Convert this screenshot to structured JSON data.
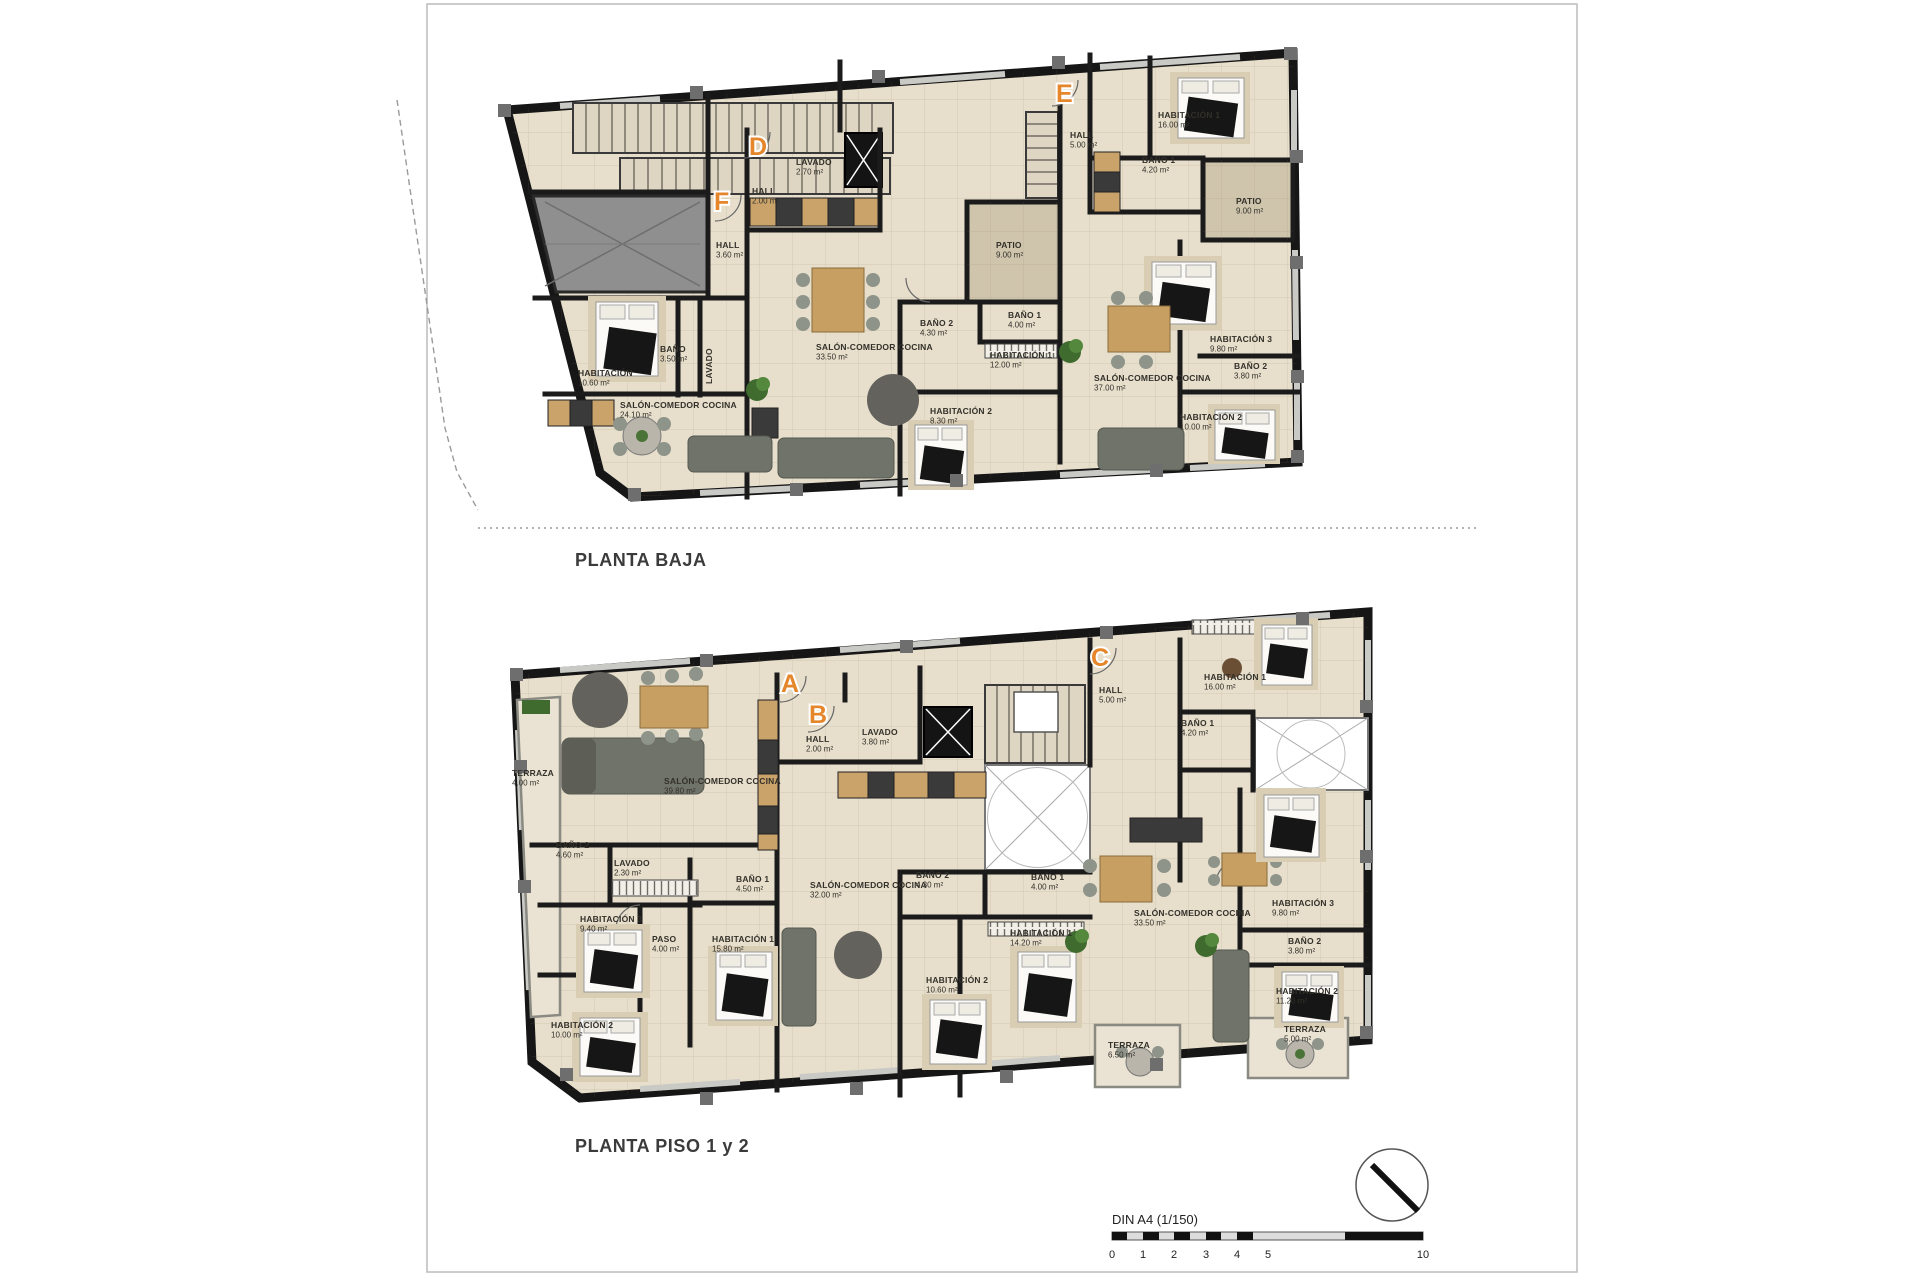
{
  "document": {
    "type": "architectural-floor-plans",
    "sheet_format": "DIN A4 (1/150)"
  },
  "colors": {
    "accent_orange": "#e5862b",
    "wall": "#1b1b1b",
    "floor": "#e7dfcc",
    "patio": "#cfc5ad",
    "ramp_grey": "#909090",
    "furniture_grey": "#70736a",
    "wood": "#c89f63"
  },
  "scale_bar": {
    "label": "DIN A4 (1/150)",
    "ticks": [
      "0",
      "1",
      "2",
      "3",
      "4",
      "5",
      "10"
    ]
  },
  "plans": [
    {
      "id": "planta-baja",
      "title": "PLANTA BAJA",
      "letters": [
        {
          "letter": "F",
          "x": 714,
          "y": 210
        },
        {
          "letter": "D",
          "x": 749,
          "y": 155
        },
        {
          "letter": "E",
          "x": 1056,
          "y": 102
        }
      ],
      "rooms": [
        {
          "name": "HALL",
          "area": "3.60 m²",
          "x": 716,
          "y": 248
        },
        {
          "name": "HABITACIÓN",
          "area": "10.60 m²",
          "x": 578,
          "y": 376
        },
        {
          "name": "BAÑO",
          "area": "3.50 m²",
          "x": 660,
          "y": 352
        },
        {
          "name": "LAVADO",
          "x": 712,
          "y": 384,
          "rotate": -90
        },
        {
          "name": "SALÓN-COMEDOR COCINA",
          "area": "24.10 m²",
          "x": 620,
          "y": 408
        },
        {
          "name": "LAVADO",
          "area": "2.70 m²",
          "x": 796,
          "y": 165
        },
        {
          "name": "HALL",
          "area": "2.00 m²",
          "x": 752,
          "y": 194
        },
        {
          "name": "PATIO",
          "area": "9.00 m²",
          "x": 996,
          "y": 248
        },
        {
          "name": "BAÑO 2",
          "area": "4.30 m²",
          "x": 920,
          "y": 326
        },
        {
          "name": "BAÑO 1",
          "area": "4.00 m²",
          "x": 1008,
          "y": 318
        },
        {
          "name": "SALÓN-COMEDOR COCINA",
          "area": "33.50 m²",
          "x": 816,
          "y": 350
        },
        {
          "name": "HABITACIÓN 1",
          "area": "12.00 m²",
          "x": 990,
          "y": 358
        },
        {
          "name": "HABITACIÓN 2",
          "area": "8.30 m²",
          "x": 930,
          "y": 414
        },
        {
          "name": "HALL",
          "area": "5.00 m²",
          "x": 1070,
          "y": 138
        },
        {
          "name": "HABITACIÓN 1",
          "area": "16.00 m²",
          "x": 1158,
          "y": 118
        },
        {
          "name": "BAÑO 1",
          "area": "4.20 m²",
          "x": 1142,
          "y": 163
        },
        {
          "name": "PATIO",
          "area": "9.00 m²",
          "x": 1236,
          "y": 204
        },
        {
          "name": "SALÓN-COMEDOR COCINA",
          "area": "37.00 m²",
          "x": 1094,
          "y": 381
        },
        {
          "name": "HABITACIÓN 3",
          "area": "9.80 m²",
          "x": 1210,
          "y": 342
        },
        {
          "name": "BAÑO 2",
          "area": "3.80 m²",
          "x": 1234,
          "y": 369
        },
        {
          "name": "HABITACIÓN 2",
          "area": "10.00 m²",
          "x": 1180,
          "y": 420
        }
      ]
    },
    {
      "id": "planta-piso-1-y-2",
      "title": "PLANTA PISO 1 y 2",
      "letters": [
        {
          "letter": "A",
          "x": 781,
          "y": 692
        },
        {
          "letter": "B",
          "x": 809,
          "y": 723
        },
        {
          "letter": "C",
          "x": 1091,
          "y": 666
        }
      ],
      "rooms": [
        {
          "name": "TERRAZA",
          "area": "4.00 m²",
          "x": 512,
          "y": 776,
          "rotate": 0
        },
        {
          "name": "SALÓN-COMEDOR COCINA",
          "area": "39.80 m²",
          "x": 664,
          "y": 784
        },
        {
          "name": "BAÑO 2",
          "area": "4.60 m²",
          "x": 556,
          "y": 848
        },
        {
          "name": "LAVADO",
          "area": "2.30 m²",
          "x": 614,
          "y": 866
        },
        {
          "name": "HABITACIÓN 3",
          "area": "9.40 m²",
          "x": 580,
          "y": 922
        },
        {
          "name": "PASO",
          "area": "4.00 m²",
          "x": 652,
          "y": 942
        },
        {
          "name": "HABITACIÓN 1",
          "area": "15.80 m²",
          "x": 712,
          "y": 942
        },
        {
          "name": "BAÑO 1",
          "area": "4.50 m²",
          "x": 736,
          "y": 882
        },
        {
          "name": "HABITACIÓN 2",
          "area": "10.00 m²",
          "x": 551,
          "y": 1028
        },
        {
          "name": "HALL",
          "area": "2.00 m²",
          "x": 806,
          "y": 742
        },
        {
          "name": "LAVADO",
          "area": "3.80 m²",
          "x": 862,
          "y": 735
        },
        {
          "name": "SALÓN-COMEDOR COCINA",
          "area": "32.00 m²",
          "x": 810,
          "y": 888
        },
        {
          "name": "BAÑO 2",
          "area": "4.30 m²",
          "x": 916,
          "y": 878
        },
        {
          "name": "BAÑO 1",
          "area": "4.00 m²",
          "x": 1031,
          "y": 880
        },
        {
          "name": "HABITACIÓN 1",
          "area": "14.20 m²",
          "x": 1010,
          "y": 936
        },
        {
          "name": "HABITACIÓN 2",
          "area": "10.60 m²",
          "x": 926,
          "y": 983
        },
        {
          "name": "TERRAZA",
          "area": "6.50 m²",
          "x": 1108,
          "y": 1048
        },
        {
          "name": "HALL",
          "area": "5.00 m²",
          "x": 1099,
          "y": 693
        },
        {
          "name": "HABITACIÓN 1",
          "area": "16.00 m²",
          "x": 1204,
          "y": 680
        },
        {
          "name": "BAÑO 1",
          "area": "4.20 m²",
          "x": 1181,
          "y": 726
        },
        {
          "name": "SALÓN-COMEDOR COCINA",
          "area": "33.50 m²",
          "x": 1134,
          "y": 916
        },
        {
          "name": "HABITACIÓN 3",
          "area": "9.80 m²",
          "x": 1272,
          "y": 906
        },
        {
          "name": "BAÑO 2",
          "area": "3.80 m²",
          "x": 1288,
          "y": 944
        },
        {
          "name": "HABITACIÓN 2",
          "area": "11.20 m²",
          "x": 1276,
          "y": 994
        },
        {
          "name": "TERRAZA",
          "area": "5.00 m²",
          "x": 1284,
          "y": 1032
        }
      ]
    }
  ]
}
